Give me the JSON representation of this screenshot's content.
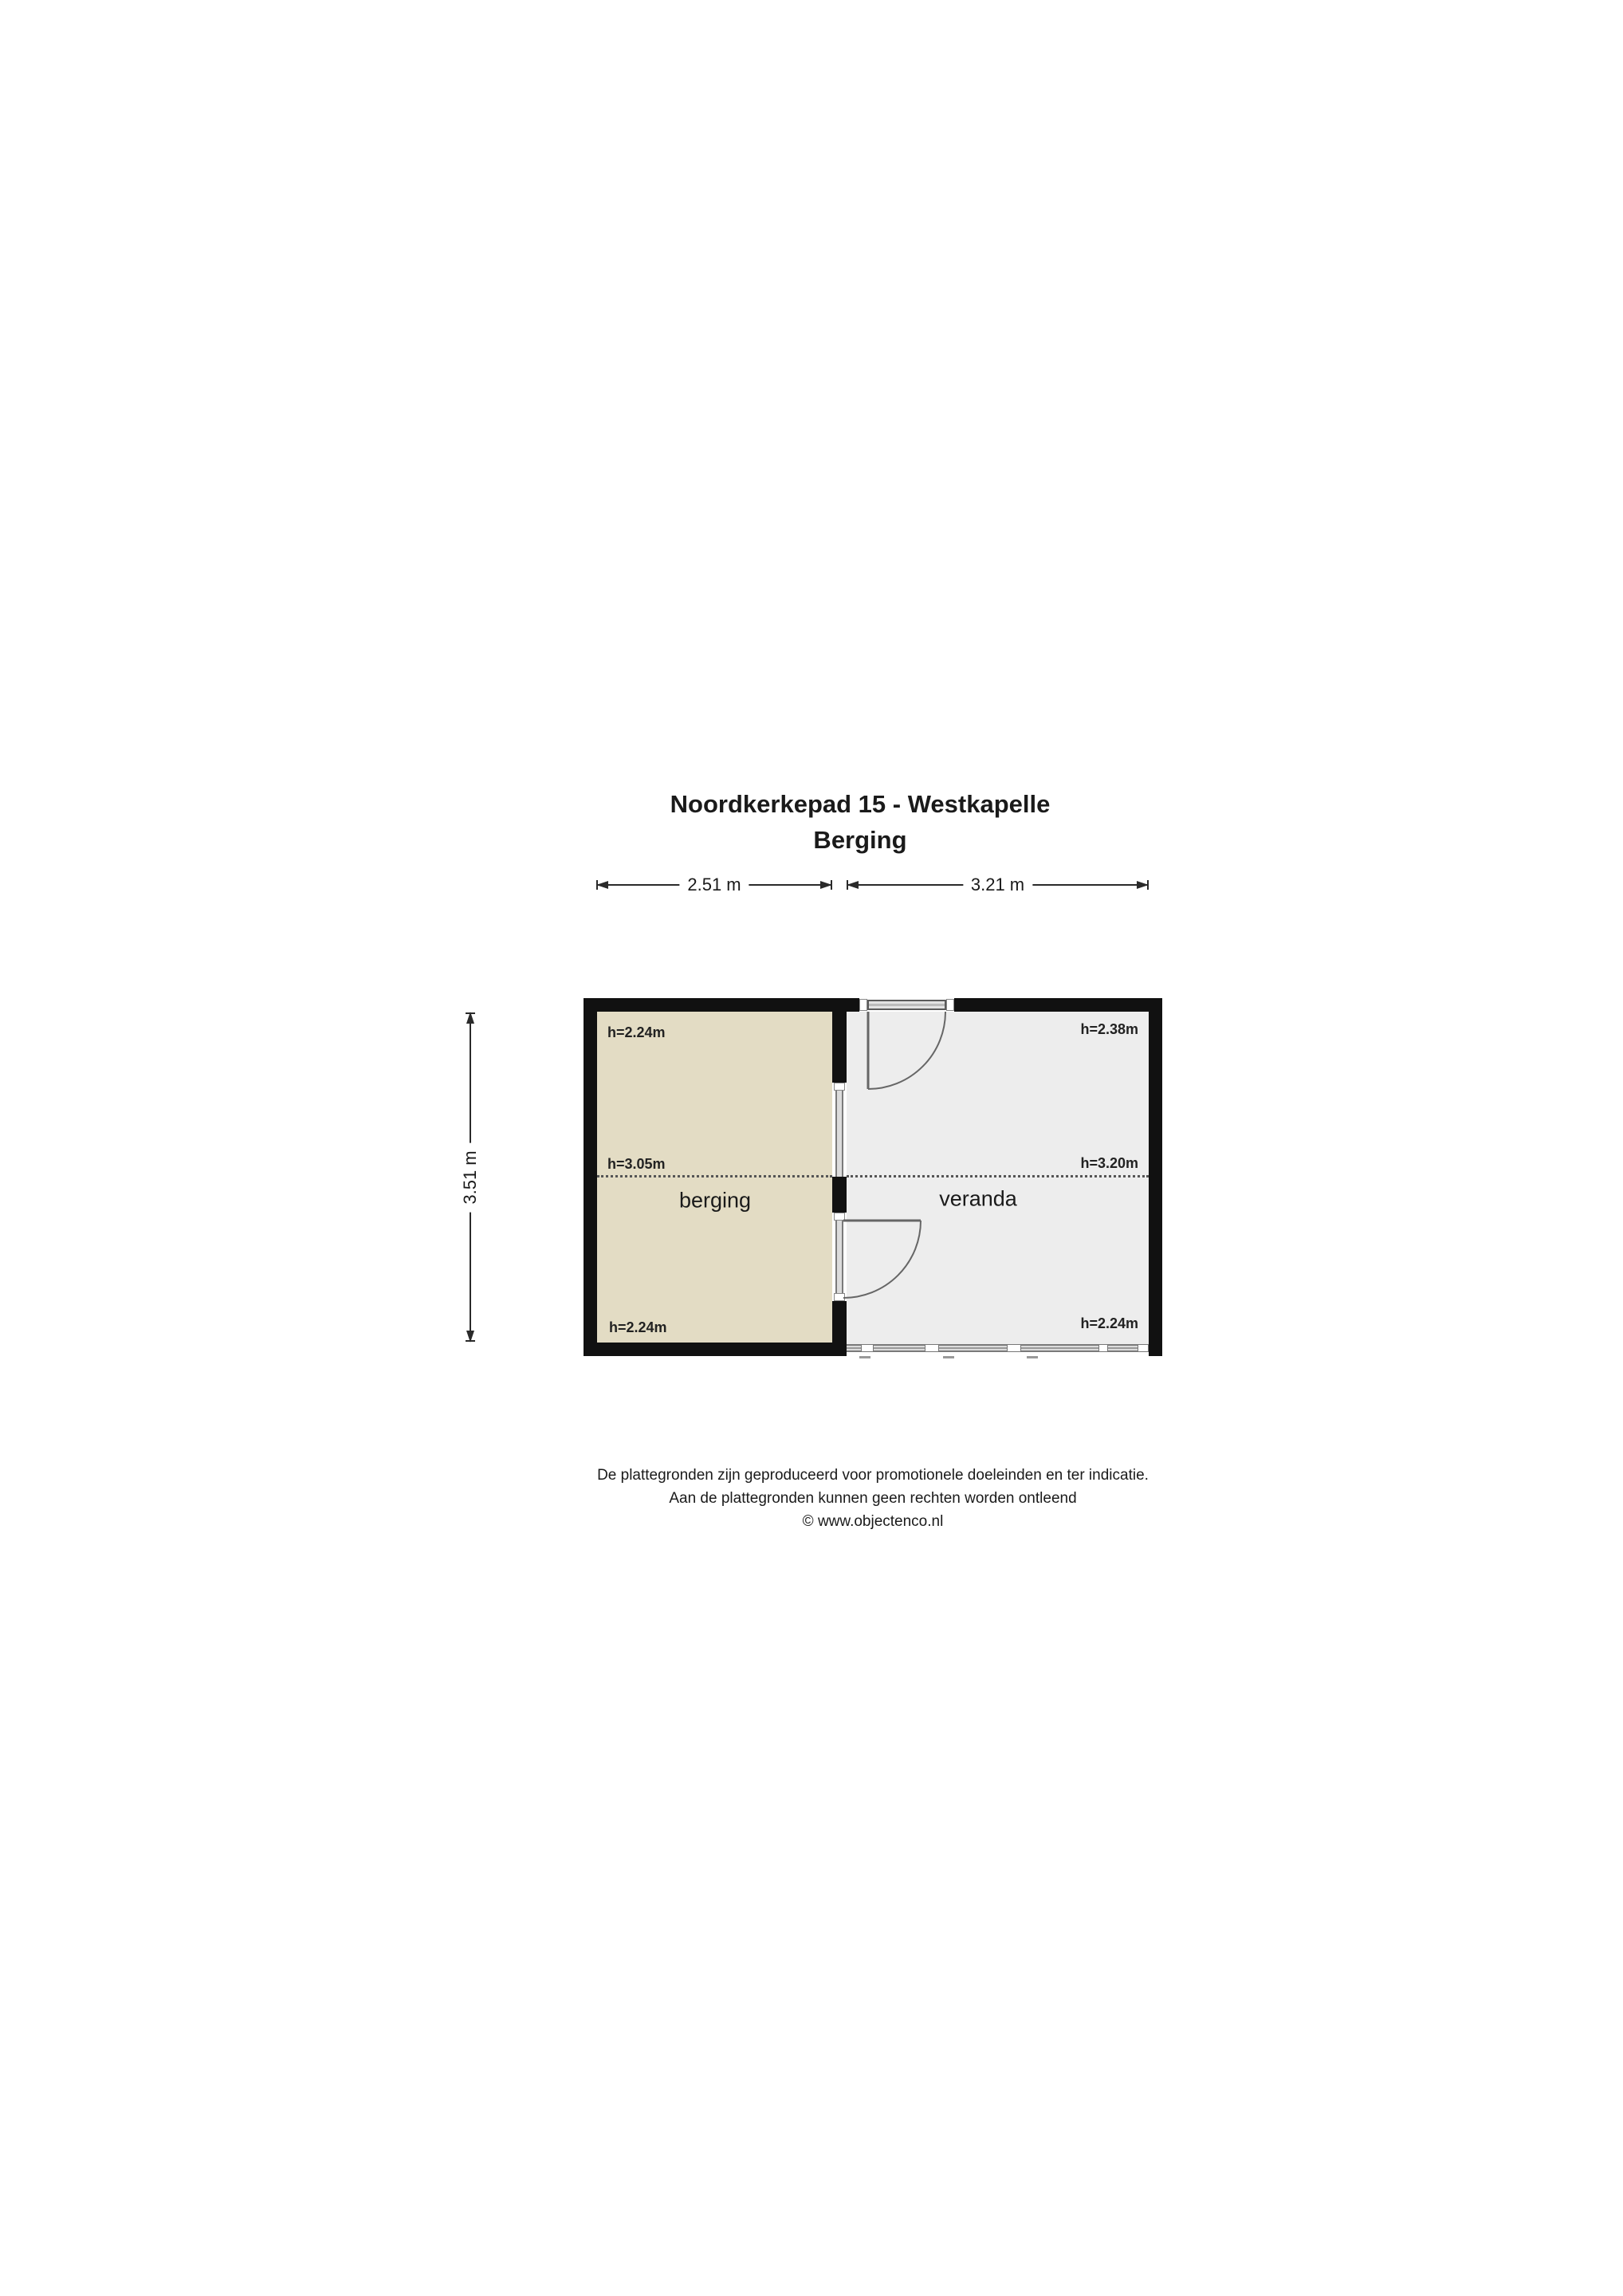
{
  "title": {
    "line1": "Noordkerkepad 15 - Westkapelle",
    "line2": "Berging"
  },
  "dimensions": {
    "top_berging": "2.51 m",
    "top_veranda": "3.21 m",
    "left_total": "3.51 m"
  },
  "rooms": [
    {
      "name": "berging",
      "label": "berging",
      "fill": "#e3dcc4",
      "heights": {
        "top": "h=2.24m",
        "middle": "h=3.05m",
        "bottom": "h=2.24m"
      }
    },
    {
      "name": "veranda",
      "label": "veranda",
      "fill": "#ededed",
      "heights": {
        "top": "h=2.38m",
        "middle": "h=3.20m",
        "bottom": "h=2.24m"
      }
    }
  ],
  "footer": {
    "line1": "De plattegronden zijn geproduceerd voor promotionele doeleinden en ter indicatie.",
    "line2": "Aan de plattegronden kunnen geen rechten worden ontleend",
    "line3": "© www.objectenco.nl"
  },
  "colors": {
    "wall": "#111111",
    "berging_fill": "#e3dcc4",
    "veranda_fill": "#ededed",
    "glazing_fill": "#dcdcdc",
    "glazing_edge": "#7a7a7a",
    "dashed_line": "#555555",
    "door_line": "#666666"
  }
}
